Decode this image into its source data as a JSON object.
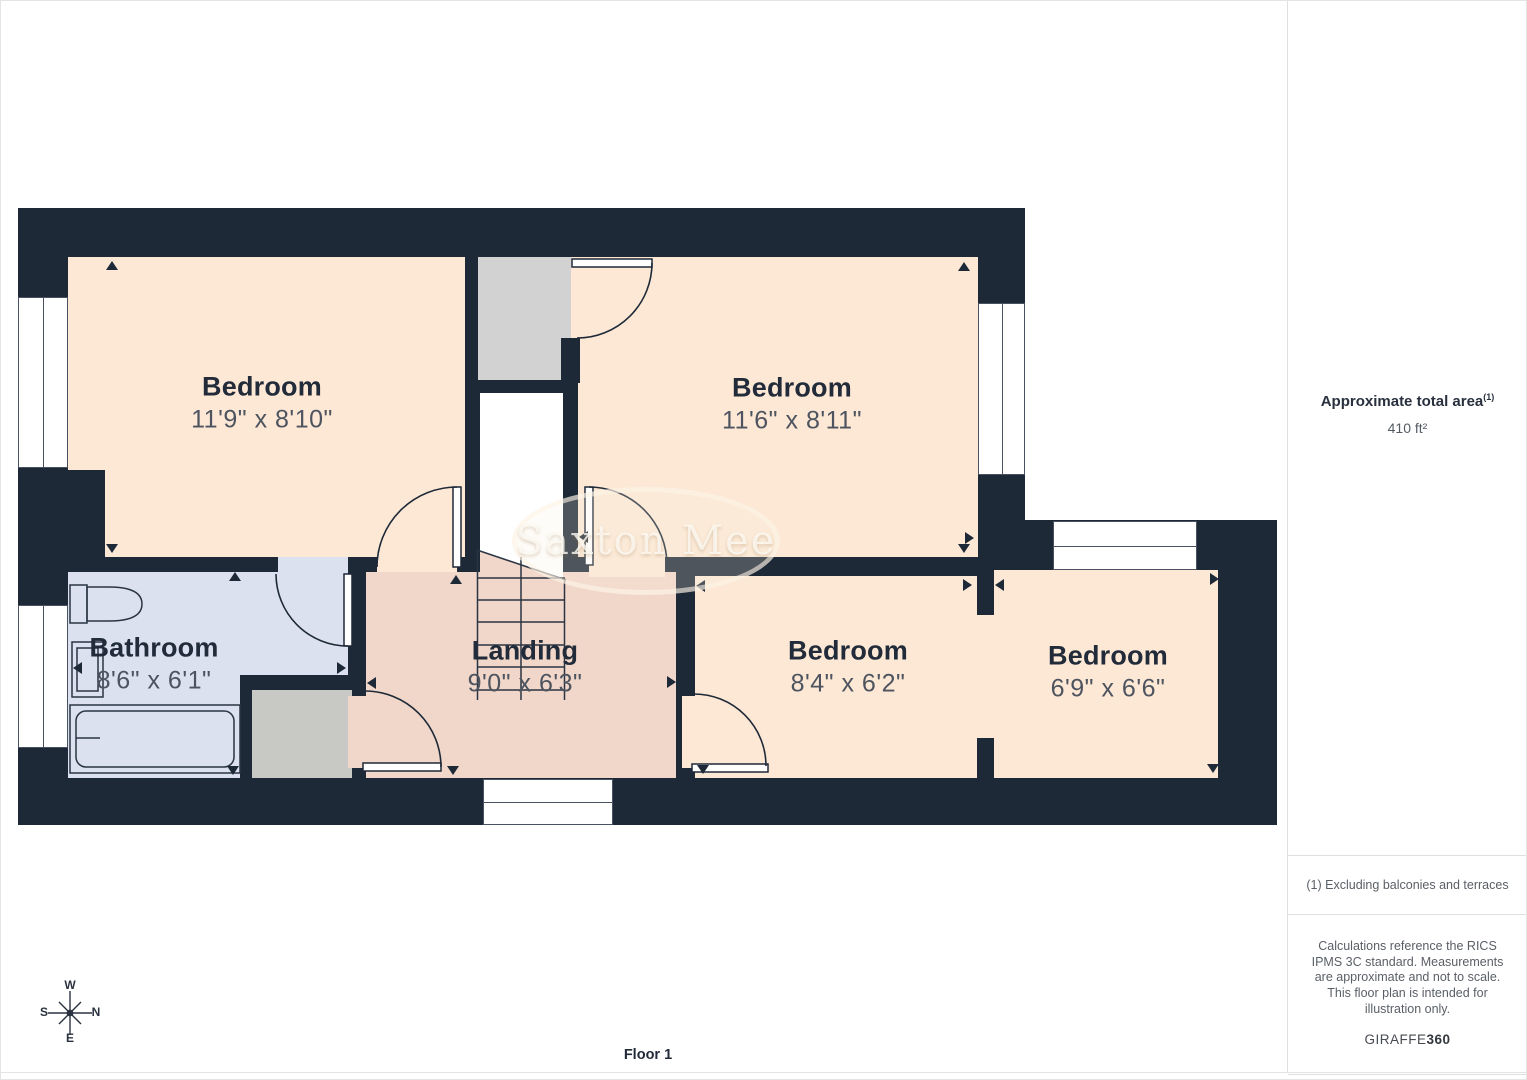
{
  "page": {
    "floor_label": "Floor 1"
  },
  "watermark": {
    "text": "Saxton Mee"
  },
  "rooms": [
    {
      "name": "Bedroom",
      "dims": "11'9\" x 8'10\""
    },
    {
      "name": "Bedroom",
      "dims": "11'6\" x 8'11\""
    },
    {
      "name": "Bathroom",
      "dims": "8'6\" x 6'1\""
    },
    {
      "name": "Landing",
      "dims": "9'0\" x 6'3\""
    },
    {
      "name": "Bedroom",
      "dims": "8'4\" x 6'2\""
    },
    {
      "name": "Bedroom",
      "dims": "6'9\" x 6'6\""
    }
  ],
  "compass": {
    "n": "N",
    "s": "S",
    "e": "E",
    "w": "W"
  },
  "sidebar": {
    "area_label": "Approximate total area",
    "area_superscript": "(1)",
    "area_value": "410 ft²",
    "footnote": "(1) Excluding balconies and terraces",
    "disclaimer": "Calculations reference the RICS IPMS 3C standard. Measurements are approximate and not to scale. This floor plan is intended for illustration only.",
    "brand_name": "GIRAFFE",
    "brand_suffix": "360"
  },
  "colors": {
    "wall": "#1e2938",
    "room_fill": "#fce8d5",
    "landing_fill": "#f1d7c9",
    "bathroom_fill": "#dbe1ee",
    "closet_fill": "#d2d2d2",
    "label_title": "#222b39",
    "label_dims": "#4e545f"
  }
}
